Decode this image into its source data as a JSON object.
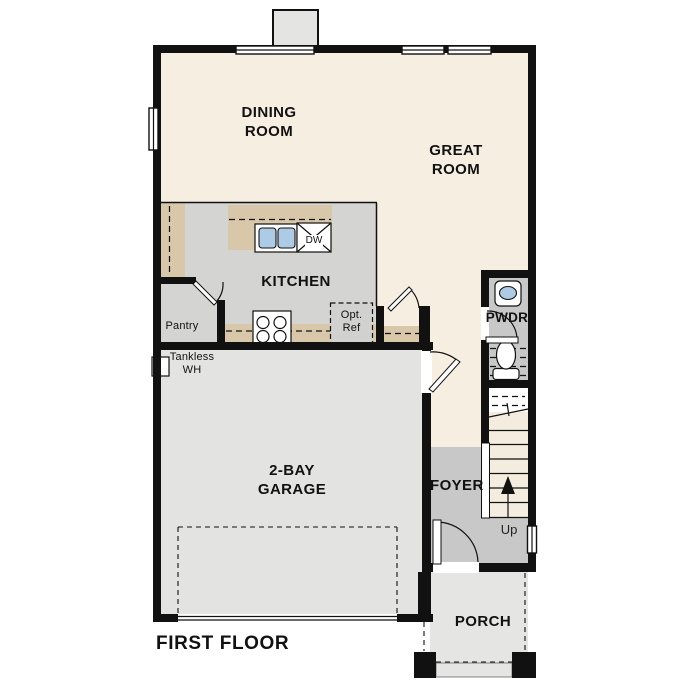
{
  "title": "FIRST FLOOR",
  "colors": {
    "wall": "#111111",
    "outline": "#111111",
    "floor_living": "#f6eee1",
    "floor_kitchen": "#d4d4d3",
    "floor_entry": "#c8c8c8",
    "floor_garage": "#e3e3e1",
    "floor_porch": "#e5e5e3",
    "counter": "#d8c7a9",
    "stair_tread": "#f4eddf",
    "fixture_blue": "#aecbe6"
  },
  "rooms": {
    "dining": {
      "label": "DINING ROOM"
    },
    "great": {
      "label": "GREAT ROOM"
    },
    "kitchen": {
      "label": "KITCHEN"
    },
    "pantry": {
      "label": "Pantry"
    },
    "powder": {
      "label": "PWDR"
    },
    "garage": {
      "label": "2-BAY GARAGE"
    },
    "foyer": {
      "label": "FOYER"
    },
    "porch": {
      "label": "PORCH"
    }
  },
  "annotations": {
    "dishwasher": "DW",
    "optional_refrigerator": "Opt. Ref",
    "tankless_water_heater": "Tankless WH",
    "stairs_direction": "Up"
  }
}
